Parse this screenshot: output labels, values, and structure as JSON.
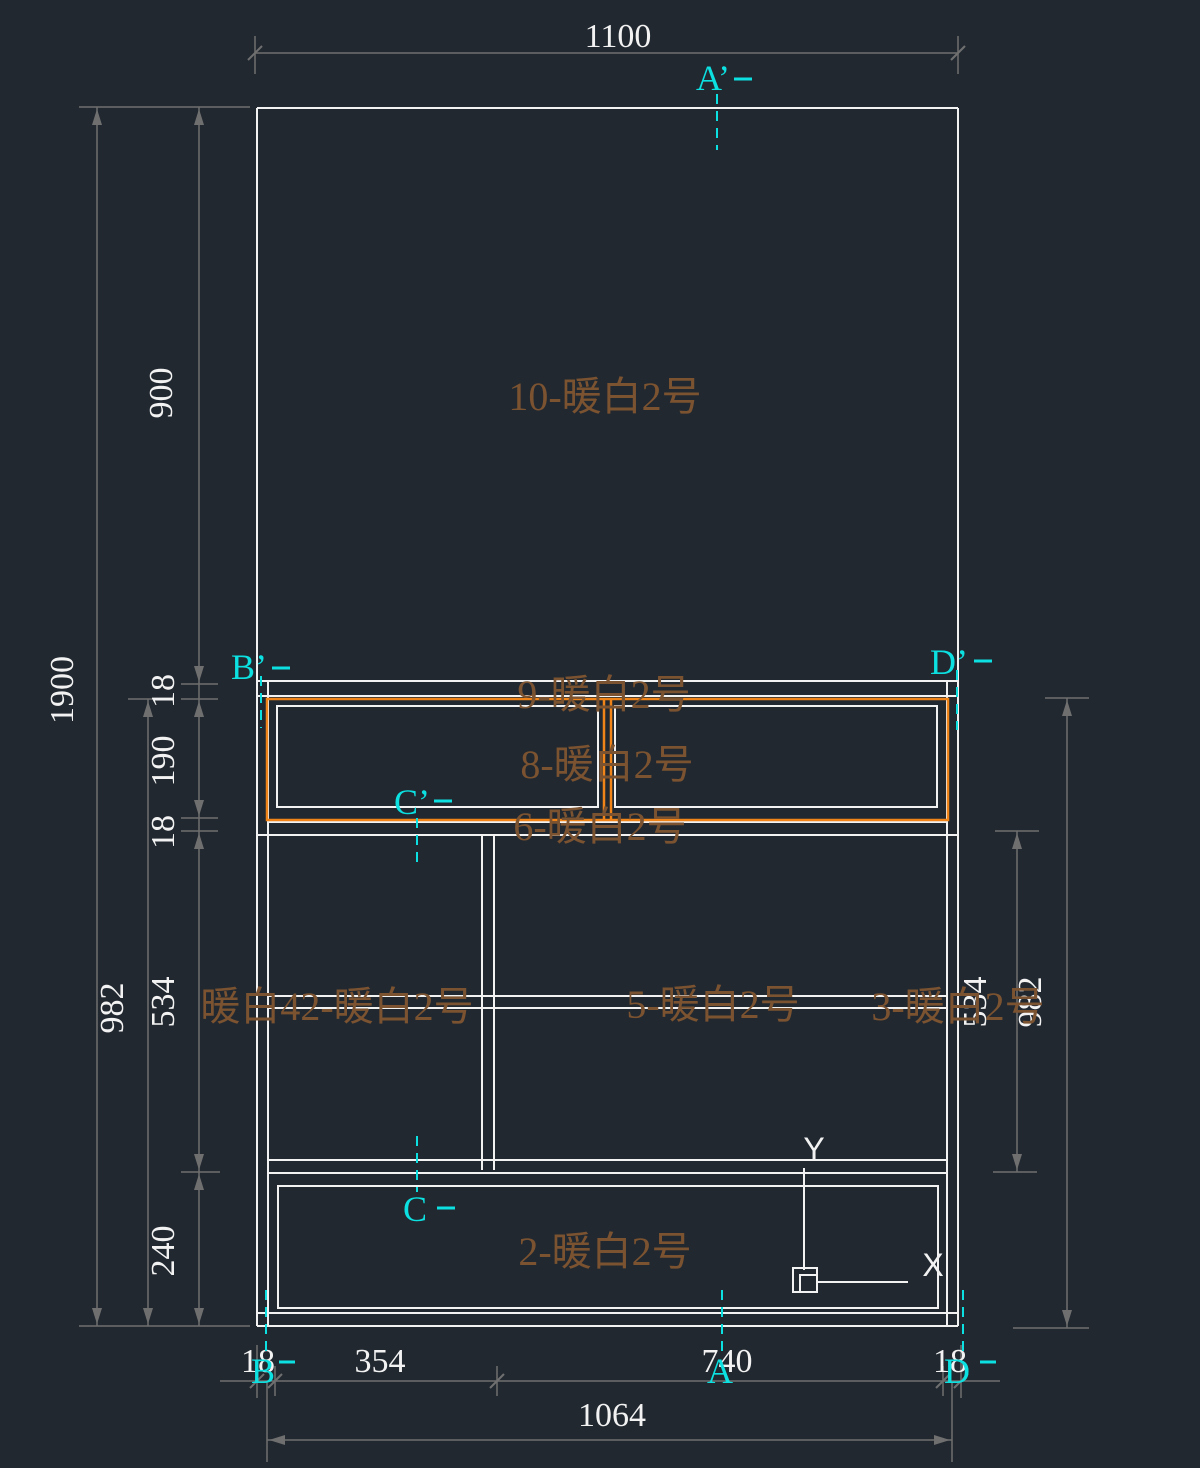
{
  "canvas": {
    "description": "CAD cabinet elevation drawing with dimensions and section markers",
    "background": "#212830"
  },
  "colors": {
    "geometry": "#f2f2f2",
    "selection_highlight": "#f08418",
    "dimension_line": "#6f6f6f",
    "dimension_text": "#f2f2f2",
    "section_marker": "#0ce0e0",
    "panel_label": "#7b5331"
  },
  "dimensions": {
    "top_width": "1100",
    "left": {
      "total_height": "1900",
      "upper_height": "900",
      "shelf_top_thickness": "18",
      "shelf_opening": "190",
      "shelf_bottom_thickness": "18",
      "cabinet_height": "982",
      "mid_section": "534",
      "base_section": "240"
    },
    "right": {
      "mid_section": "534",
      "cabinet_height": "982"
    },
    "bottom": {
      "left_panel": "18",
      "left_bay": "354",
      "right_bay": "740",
      "right_panel": "18",
      "inner_width": "1064"
    }
  },
  "section_markers": {
    "a_top": "A’",
    "b_top": "B’",
    "c_top": "C’",
    "d_top": "D’",
    "c_bottom": "C",
    "b_bottom": "B",
    "a_bottom": "A",
    "d_bottom": "D"
  },
  "panel_labels": [
    {
      "text": "10-暖白2号"
    },
    {
      "text": "9-暖白2号"
    },
    {
      "text": "8-暖白2号"
    },
    {
      "text": "6-暖白2号"
    },
    {
      "text": "暖白42-暖白2号"
    },
    {
      "text": "5-暖白2号"
    },
    {
      "text": "3-暖白2号"
    },
    {
      "text": "2-暖白2号"
    }
  ],
  "ucs_icon": {
    "x_label": "X",
    "y_label": "Y"
  }
}
